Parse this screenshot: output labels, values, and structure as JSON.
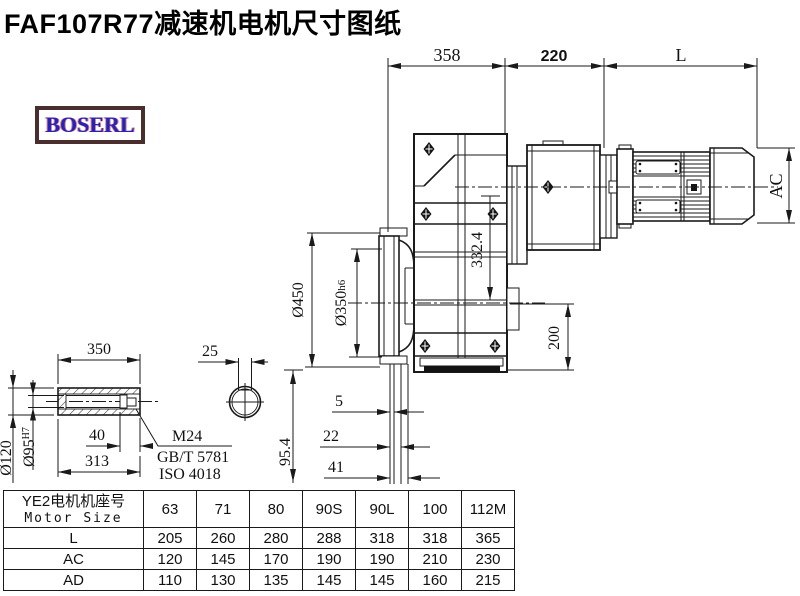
{
  "title": "FAF107R77减速机电机尺寸图纸",
  "logo": {
    "text": "BOSERL"
  },
  "dimensions": {
    "gearbox_width": "358",
    "adapter_width": "220",
    "motor_length": "L",
    "motor_height": "AC",
    "flange_outer_diameter": "Ø450",
    "flange_spigot_diameter": "Ø350",
    "flange_spigot_tolerance": "h6",
    "input_center_height": "332.4",
    "output_center_to_base": "200",
    "flange_step_1": "5",
    "flange_step_2": "22",
    "flange_step_3": "41",
    "shaft_length": "350",
    "keyway_width": "25",
    "shaft_outer_diameter": "Ø120",
    "shaft_bore_diameter": "Ø95",
    "shaft_bore_tolerance": "H7",
    "shaft_end_depth": "40",
    "shaft_usable_length": "313",
    "center_offset": "95.4",
    "thread_spec": "M24",
    "thread_standard_gb": "GB/T 5781",
    "thread_standard_iso": "ISO 4018"
  },
  "table": {
    "header_cn": "YE2电机机座号",
    "header_en": "Motor Size",
    "columns": [
      "63",
      "71",
      "80",
      "90S",
      "90L",
      "100",
      "112M"
    ],
    "rows": [
      {
        "label": "L",
        "values": [
          "205",
          "260",
          "280",
          "288",
          "318",
          "318",
          "365"
        ]
      },
      {
        "label": "AC",
        "values": [
          "120",
          "145",
          "170",
          "190",
          "190",
          "210",
          "230"
        ]
      },
      {
        "label": "AD",
        "values": [
          "110",
          "130",
          "135",
          "145",
          "145",
          "160",
          "215"
        ]
      }
    ]
  }
}
